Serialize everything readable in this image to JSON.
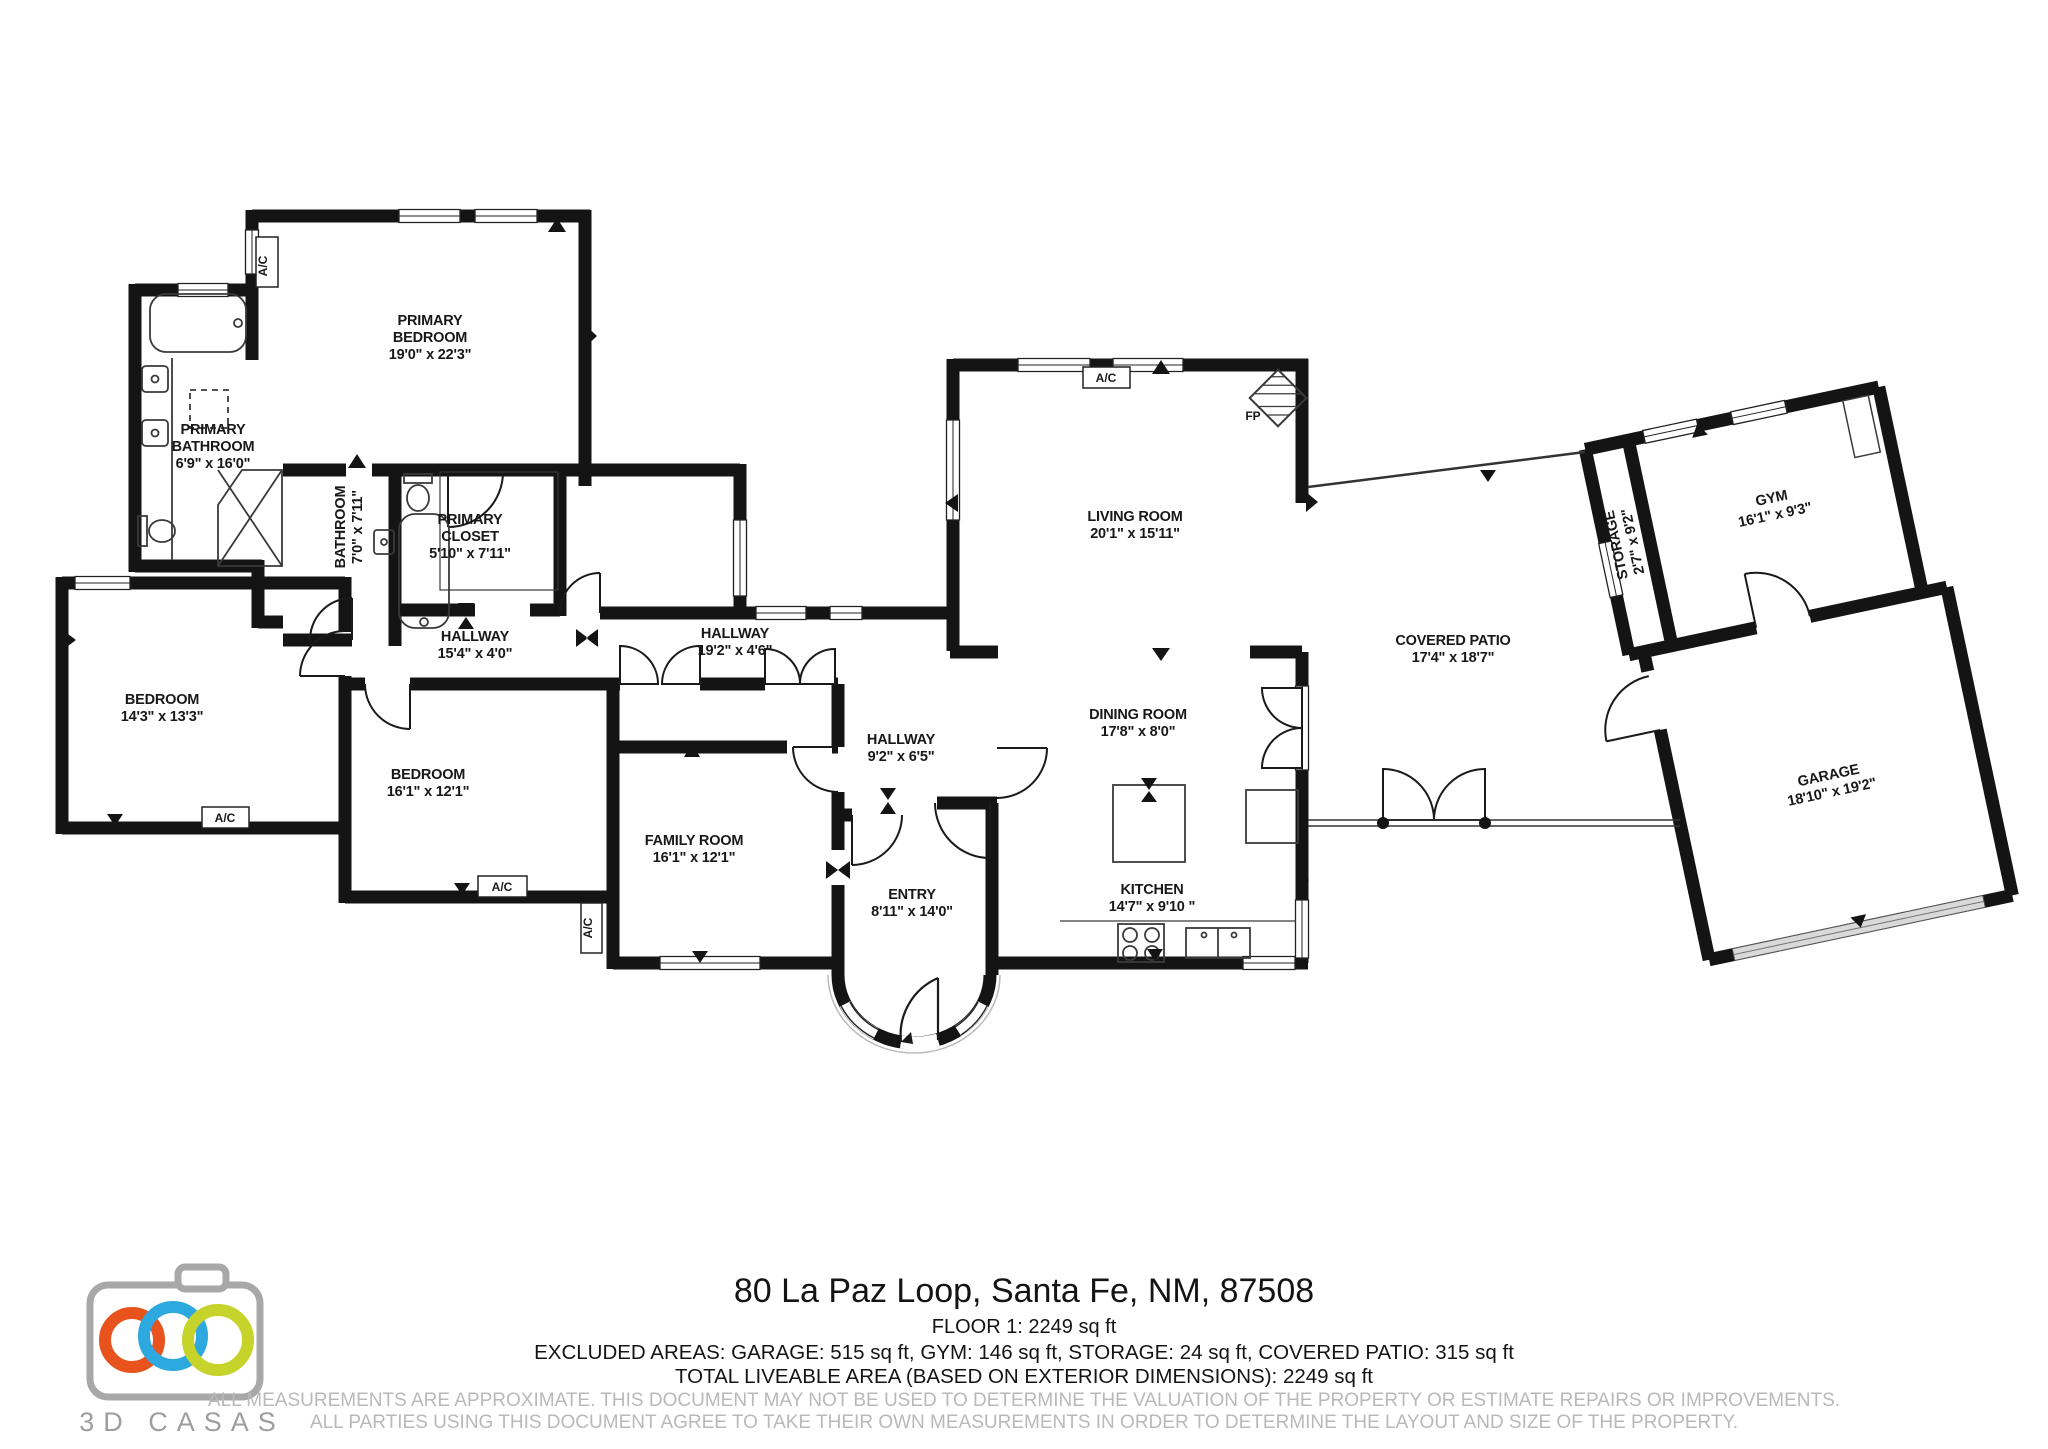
{
  "rooms": [
    {
      "id": "primary-bedroom",
      "lines": [
        "PRIMARY",
        "BEDROOM",
        "19'0\" x 22'3\""
      ],
      "x": 430,
      "y": 325,
      "rot": 0,
      "group": "main"
    },
    {
      "id": "primary-bathroom",
      "lines": [
        "PRIMARY",
        "BATHROOM",
        "6'9\" x 16'0\""
      ],
      "x": 213,
      "y": 434,
      "rot": 0,
      "group": "main"
    },
    {
      "id": "bathroom",
      "lines": [
        "BATHROOM",
        "7'0\" x 7'11\""
      ],
      "x": 345,
      "y": 527,
      "rot": -90,
      "group": "main"
    },
    {
      "id": "primary-closet",
      "lines": [
        "PRIMARY",
        "CLOSET",
        "5'10\" x 7'11\""
      ],
      "x": 470,
      "y": 524,
      "rot": 0,
      "group": "main"
    },
    {
      "id": "hallway-15",
      "lines": [
        "HALLWAY",
        "15'4\" x 4'0\""
      ],
      "x": 475,
      "y": 641,
      "rot": 0,
      "group": "main"
    },
    {
      "id": "hallway-19",
      "lines": [
        "HALLWAY",
        "19'2\" x 4'6\""
      ],
      "x": 735,
      "y": 638,
      "rot": 0,
      "group": "main"
    },
    {
      "id": "hallway-9",
      "lines": [
        "HALLWAY",
        "9'2\" x 6'5\""
      ],
      "x": 901,
      "y": 744,
      "rot": 0,
      "group": "main"
    },
    {
      "id": "bedroom-14",
      "lines": [
        "BEDROOM",
        "14'3\" x 13'3\""
      ],
      "x": 162,
      "y": 704,
      "rot": 0,
      "group": "main"
    },
    {
      "id": "bedroom-16",
      "lines": [
        "BEDROOM",
        "16'1\" x 12'1\""
      ],
      "x": 428,
      "y": 779,
      "rot": 0,
      "group": "main"
    },
    {
      "id": "family-room",
      "lines": [
        "FAMILY ROOM",
        "16'1\" x 12'1\""
      ],
      "x": 694,
      "y": 845,
      "rot": 0,
      "group": "main"
    },
    {
      "id": "entry",
      "lines": [
        "ENTRY",
        "8'11\" x 14'0\""
      ],
      "x": 912,
      "y": 899,
      "rot": 0,
      "group": "main"
    },
    {
      "id": "living-room",
      "lines": [
        "LIVING ROOM",
        "20'1\" x 15'11\""
      ],
      "x": 1135,
      "y": 521,
      "rot": 0,
      "group": "main"
    },
    {
      "id": "dining-room",
      "lines": [
        "DINING ROOM",
        "17'8\" x 8'0\""
      ],
      "x": 1138,
      "y": 719,
      "rot": 0,
      "group": "main"
    },
    {
      "id": "kitchen",
      "lines": [
        "KITCHEN",
        "14'7\" x 9'10 \""
      ],
      "x": 1152,
      "y": 894,
      "rot": 0,
      "group": "main"
    },
    {
      "id": "covered-patio",
      "lines": [
        "COVERED PATIO",
        "17'4\" x 18'7\""
      ],
      "x": 1453,
      "y": 645,
      "rot": 0,
      "group": "main"
    },
    {
      "id": "storage",
      "lines": [
        "STORAGE",
        "2'7\" x 9'2\""
      ],
      "x": 1655,
      "y": 510,
      "rot": -90,
      "group": "outbuilding"
    },
    {
      "id": "gym",
      "lines": [
        "GYM",
        "16'1\" x 9'3\""
      ],
      "x": 1812,
      "y": 501,
      "rot": 0,
      "group": "outbuilding"
    },
    {
      "id": "garage",
      "lines": [
        "GARAGE",
        "18'10\" x 19'2\""
      ],
      "x": 1810,
      "y": 784,
      "rot": 0,
      "group": "outbuilding"
    }
  ],
  "markers": [
    {
      "id": "ac-primary-bedroom",
      "text": "A/C",
      "x": 267,
      "y": 266,
      "rot": -90
    },
    {
      "id": "ac-living-room",
      "text": "A/C",
      "x": 1106,
      "y": 382,
      "rot": 0
    },
    {
      "id": "ac-bedroom-14",
      "text": "A/C",
      "x": 225,
      "y": 822,
      "rot": 0
    },
    {
      "id": "ac-bedroom-16",
      "text": "A/C",
      "x": 502,
      "y": 891,
      "rot": 0
    },
    {
      "id": "ac-family-room",
      "text": "A/C",
      "x": 592,
      "y": 928,
      "rot": -90
    },
    {
      "id": "fireplace",
      "text": "FP",
      "x": 1253,
      "y": 420,
      "rot": 0
    }
  ],
  "footer": {
    "address": "80 La Paz Loop, Santa Fe, NM, 87508",
    "floor_line": "FLOOR 1: 2249 sq ft",
    "excluded_line": "EXCLUDED AREAS: GARAGE: 515 sq ft, GYM: 146 sq ft, STORAGE: 24 sq ft, COVERED PATIO: 315 sq ft",
    "total_line": "TOTAL LIVEABLE AREA (BASED ON EXTERIOR DIMENSIONS): 2249 sq ft",
    "disclaimer_line1": "ALL MEASUREMENTS ARE APPROXIMATE. THIS DOCUMENT MAY NOT BE USED TO DETERMINE THE VALUATION OF THE PROPERTY OR ESTIMATE REPAIRS OR IMPROVEMENTS.",
    "disclaimer_line2": "ALL PARTIES USING THIS DOCUMENT AGREE TO TAKE THEIR OWN MEASUREMENTS IN ORDER TO DETERMINE THE LAYOUT AND SIZE OF THE PROPERTY."
  },
  "logo": {
    "text": "3D CASAS",
    "camera_color": "#a8a8a8",
    "ring_colors": [
      "#e8521d",
      "#2ea9e0",
      "#c6d32b"
    ],
    "text_color": "#9e9e9e"
  }
}
